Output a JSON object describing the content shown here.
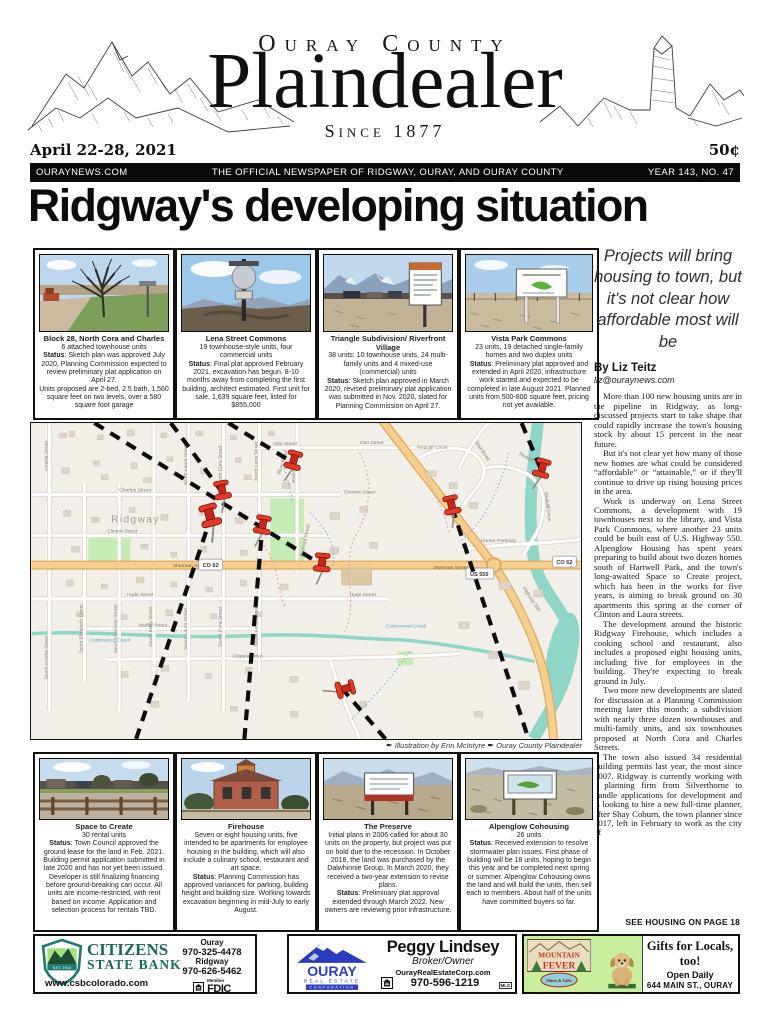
{
  "masthead": {
    "kicker": "Ouray County",
    "title": "Plaindealer",
    "tagline": "Since 1877"
  },
  "dateline": {
    "date": "April 22-28, 2021",
    "price": "50¢"
  },
  "banner": {
    "site": "OURAYNEWS.COM",
    "tagline": "THE OFFICIAL NEWSPAPER OF RIDGWAY, OURAY, AND OURAY COUNTY",
    "issue": "YEAR 143, NO. 47"
  },
  "headline": "Ridgway's developing situation",
  "labels": {
    "status": "Status"
  },
  "story": {
    "deck": "Projects will bring housing to town, but it's not clear how affordable most will be",
    "byline": "By Liz Teitz",
    "email": "liz@ouraynews.com",
    "paragraphs": [
      "More than 100 new housing units are in the pipeline in Ridgway, as long-discussed projects start to take shape that could rapidly increase the town's housing stock by about 15 percent in the near future.",
      "But it's not clear yet how many of those new homes are what could be considered “affordable” or “attainable,” or if they'll continue to drive up rising housing prices in the area.",
      "Work is underway on Lena Street Commons, a development with 19 townhouses next to the library, and Vista Park Commons, where another 23 units could be built east of U.S. Highway 550. Alpenglow Housing has spent years preparing to build about two dozen homes south of Hartwell Park, and the town's long-awaited Space to Create project, which has been in the works for five years, is aiming to break ground on 30 apartments this spring at the corner of Clinton and Laura streets.",
      "The development around the historic Ridgway Firehouse, which includes a cooking school and restaurant, also includes a proposed eight housing units, including five for employees in the building. They're expecting to break ground in July.",
      "Two more new developments are slated for discussion at a Planning Commission meeting later this month: a subdivision with nearly three dozen townhouses and multi-family units, and six townhouses proposed at North Cora and Charles Streets.",
      "The town also issued 34 residential building permits last year, the most since 2007. Ridgway is currently working with a planning firm from Silverthorne to handle applications for development and is looking to hire a new full-time planner, after Shay Coburn, the town planner since 2017, left in February to work as the city of"
    ],
    "continuation": "SEE HOUSING ON PAGE 18"
  },
  "top_boxes": [
    {
      "title": "Block 28, North Cora and Charles",
      "sub": "6 attached townhouse units",
      "status": ": Sketch plan was approved July 2020, Planning Commission expected to review preliminary plat application on April 27.",
      "post": "Units proposed are 2-bed, 2.5 bath, 1,560 square feet on two levels, over a 580 square foot garage"
    },
    {
      "title": "Lena Street Commons",
      "sub": "19 townhouse-style units, four commercial units",
      "status": ": Final plat approved February 2021, excavation has begun. 8-10 months away from completing the first building, architect estimated. First unit for sale, 1,639 square feet, listed for $855,000",
      "post": ""
    },
    {
      "title": "Triangle Subdivision/ Riverfront Village",
      "sub": "38 units: 10 townhouse units, 24 multi-family units and 4 mixed-use (commercial) units",
      "status": ": Sketch plan approved in March 2020, revised preliminary plat application was submitted in Nov. 2020, slated for Planning Commission on April 27.",
      "post": ""
    },
    {
      "title": "Vista Park Commons",
      "sub": "23 units, 19 detached single-family homes and two duplex units",
      "status": ": Preliminary plat approved and extended in April 2020, infrastructure work started and expected to be completed in late August 2021. Planned units from 500-800 square feet, pricing not yet available.",
      "post": ""
    }
  ],
  "bottom_boxes": [
    {
      "title": "Space to Create",
      "sub": "30 rental units",
      "status": ": Town Council approved the ground lease for the land in Feb. 2021. Building permit application submitted in late 2020 and has not yet been issued. Developer is still finalizing financing before ground-breaking can occur. All units are income-restricted, with rent based on income. Application and selection process for rentals TBD.",
      "post": ""
    },
    {
      "title": "Firehouse",
      "sub": "Seven or eight housing units, five intended to be apartments for employee housing in the building, which will also include a culinary school, restaurant and art space.",
      "status": ": Planning Commission has approved variances for parking, building height and building size. Working towards excavation beginning in mid-July to early August.",
      "post": ""
    },
    {
      "title": "The Preserve",
      "sub": "Initial plans in 2006 called for about 30 units on the property, but project was put on hold due to the recession. In October 2018, the land was purchased by the Dalwhinnie Group. In March 2020, they received a two-year extension to revise plans.",
      "status": ": Preliminary plat approval extended through March 2022. New owners are reviewing prior infrastructure.",
      "post": ""
    },
    {
      "title": "Alpenglow Cohousing",
      "sub": "26 units",
      "status": ": Received extension to resolve stormwater plan issues. First phase of building will be 18 units, hoping to begin this year and be completed next spring or summer. Alpenglow Cohousing owns the land and will build the units, then sell each to members. About half of the units have committed buyers so far.",
      "post": ""
    }
  ],
  "map": {
    "attribution": "Illustration by Erin McIntyre",
    "credit": "Ouray County  Plaindealer",
    "shields": [
      "CO 62",
      "CO 62",
      "US 550"
    ],
    "labels": [
      {
        "text": "Otto Street"
      },
      {
        "text": "Otto Street"
      },
      {
        "text": "Charles Street"
      },
      {
        "text": "Charles Street"
      },
      {
        "text": "Clinton Street"
      },
      {
        "text": "Sherman Street"
      },
      {
        "text": "Sherman Street"
      },
      {
        "text": "Hyde Street"
      },
      {
        "text": "Hyde Street"
      },
      {
        "text": "Moffat Street"
      },
      {
        "text": "Chipeta Drive"
      },
      {
        "text": "Cottonwood Creek"
      },
      {
        "text": "Cottonwood Creek"
      },
      {
        "text": "Hunter Parkway"
      },
      {
        "text": "Redcliff Circle"
      },
      {
        "text": "Mail Road"
      },
      {
        "text": "Redcliff Drive"
      },
      {
        "text": "Redcliff Drive"
      },
      {
        "text": "Highway 550"
      },
      {
        "text": "North Cora Street"
      },
      {
        "text": "South Cora Street"
      },
      {
        "text": "North Lena Street"
      },
      {
        "text": "South Lena Street"
      },
      {
        "text": "Railroad Street"
      },
      {
        "text": "Railroad Street"
      },
      {
        "text": "North Laura Street"
      },
      {
        "text": "South Laura Street"
      },
      {
        "text": "South Mary Street"
      },
      {
        "text": "South Charlotte Street"
      },
      {
        "text": "South Elizabeth Street"
      },
      {
        "text": "Amelia Street"
      },
      {
        "text": "South Amelia Street"
      },
      {
        "text": "Ridgway"
      },
      {
        "text": "River Road"
      }
    ]
  },
  "ads": {
    "citizens": {
      "name1": "CITIZENS",
      "name2": "STATE BANK",
      "est": "EST. 1913",
      "website": "www.csbcolorado.com",
      "loc1": "Ouray",
      "phone1": "970-325-4478",
      "loc2": "Ridgway",
      "phone2": "970-626-5462",
      "member": "Member",
      "fdic": "FDIC"
    },
    "ouray_re": {
      "logo1": "OURAY",
      "logo2": "REAL ESTATE",
      "logo3": "CORPORATION",
      "name": "Peggy Lindsey",
      "role": "Broker/Owner",
      "website": "OurayRealEstateCorp.com",
      "phone": "970-596-1219",
      "mls": "MLS"
    },
    "mountain_fever": {
      "logo1": "MOUNTAIN",
      "logo2": "FEVER",
      "logo3": "Shirts & Gifts",
      "headline": "Gifts for Locals, too!",
      "line1": "Open Daily",
      "line2": "644 MAIN ST., OURAY",
      "phone": "970-325-4408",
      "website": "MountainFeverShirts.com"
    }
  }
}
